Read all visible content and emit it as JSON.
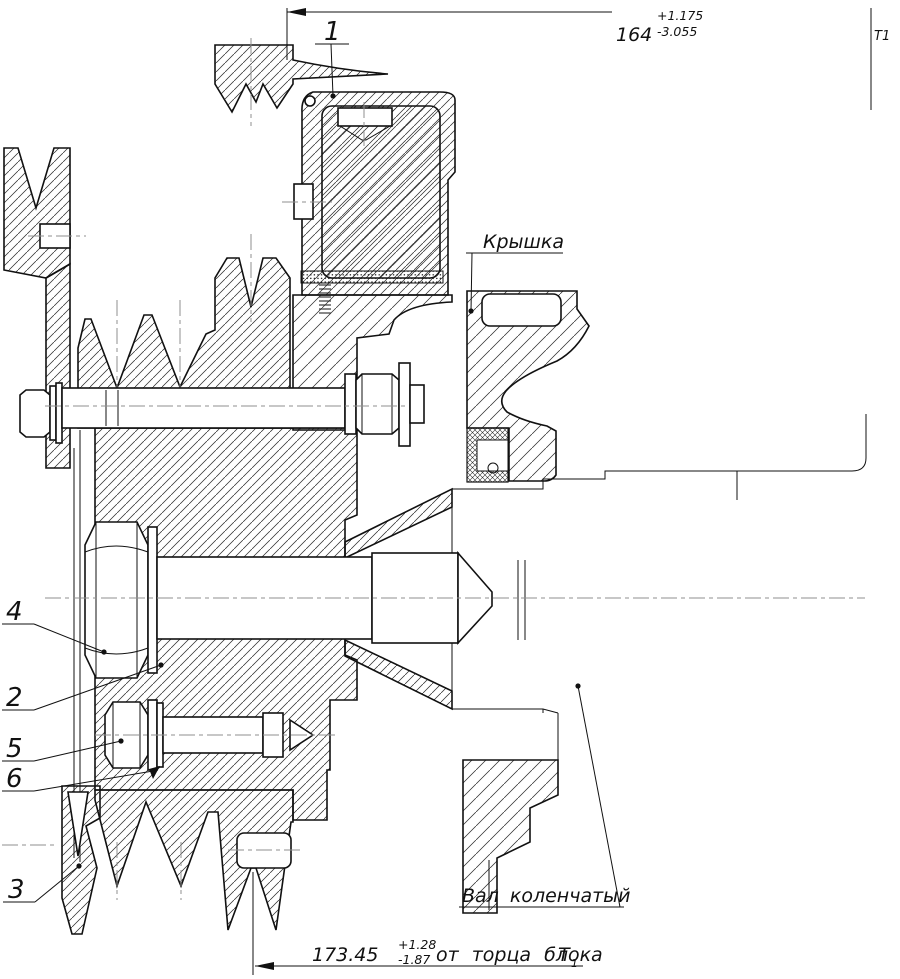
{
  "drawing": {
    "labels": {
      "cover": "Крышка",
      "crankshaft": "Вал коленчатый"
    },
    "callouts": {
      "c1": "1",
      "c2": "2",
      "c3": "3",
      "c4": "4",
      "c5": "5",
      "c6": "6"
    },
    "dimensions": {
      "top": {
        "value": "164",
        "plus": "+1.175",
        "minus": "-3.055"
      },
      "bottom": {
        "value": "173.45",
        "plus": "+1.28",
        "minus": "-1.87",
        "suffix": "от торца блока",
        "datum": "Т",
        "datum_index": "1"
      }
    },
    "datum_top_right": "T1"
  }
}
